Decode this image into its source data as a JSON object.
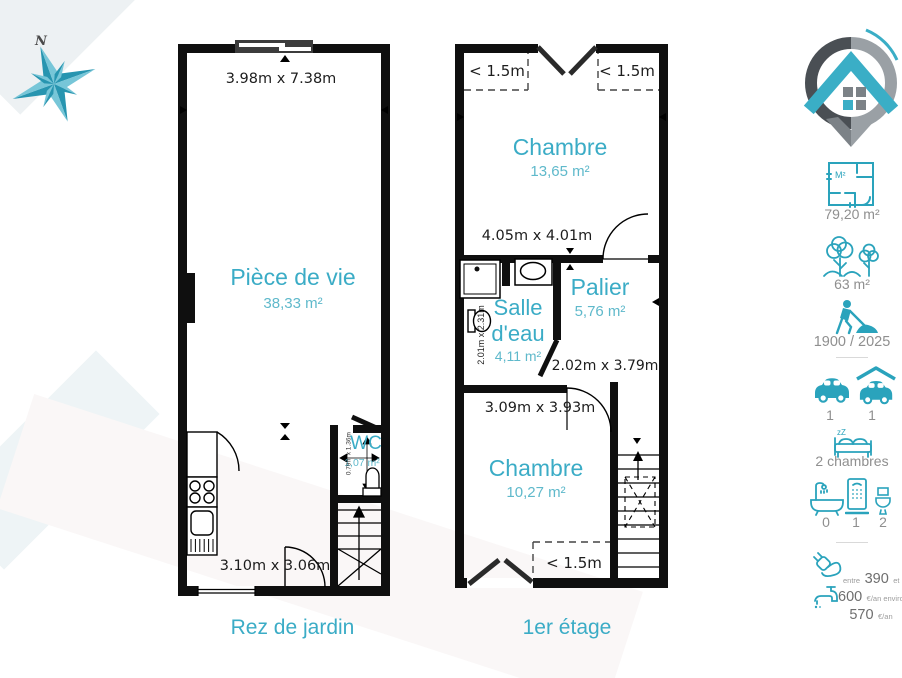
{
  "compass": {
    "north": "N"
  },
  "plan1": {
    "name": "Rez de jardin",
    "dim_top": "3.98m x 7.38m",
    "living": {
      "label": "Pièce de vie",
      "area": "38,33 m²"
    },
    "dim_bottom": "3.10m x 3.06m",
    "wc": {
      "label": "WC",
      "area": "1,07 m²",
      "dims": "0.79m x 1.36m"
    }
  },
  "plan2": {
    "name": "1er étage",
    "attic_top_left": "< 1.5m",
    "attic_top_right": "< 1.5m",
    "attic_bottom": "< 1.5m",
    "bedroom1": {
      "label": "Chambre",
      "area": "13,65 m²",
      "dims": "4.05m x 4.01m"
    },
    "bathroom": {
      "label": "Salle d'eau",
      "area": "4,11 m²",
      "dims": "2.01m x 2.31m"
    },
    "landing": {
      "label": "Palier",
      "area": "5,76 m²",
      "dims": "2.02m x 3.79m"
    },
    "bedroom2": {
      "label": "Chambre",
      "area": "10,27 m²",
      "dims": "3.09m x 3.93m"
    }
  },
  "sidebar": {
    "living_area": {
      "icon": "floorplan-icon",
      "badge": "M²",
      "value": "79,20 m²"
    },
    "land_area": {
      "icon": "trees-icon",
      "value": "63 m²"
    },
    "years": {
      "icon": "construction-worker-icon",
      "value": "1900 / 2025"
    },
    "parking": [
      {
        "icon": "car-icon",
        "value": "1"
      },
      {
        "icon": "carport-icon",
        "value": "1"
      }
    ],
    "bedrooms": {
      "icon": "bed-icon",
      "zzz": "zZ",
      "value": "2 chambres"
    },
    "bathrooms": [
      {
        "icon": "bathtub-icon",
        "value": "0"
      },
      {
        "icon": "shower-icon",
        "value": "1"
      },
      {
        "icon": "toilet-icon",
        "value": "2"
      }
    ],
    "energy": {
      "icon": "plug-icon",
      "prefix": "entre",
      "v1": "390",
      "conj": "et",
      "v2": "570",
      "unit": "€/an"
    },
    "water": {
      "icon": "tap-icon",
      "v": "600",
      "unit": "€/an environ"
    }
  },
  "colors": {
    "accent": "#3BACC6",
    "icon_teal": "#2AA3BC",
    "wall": "#0f0f0f",
    "gray_text": "#8f8f8f"
  }
}
